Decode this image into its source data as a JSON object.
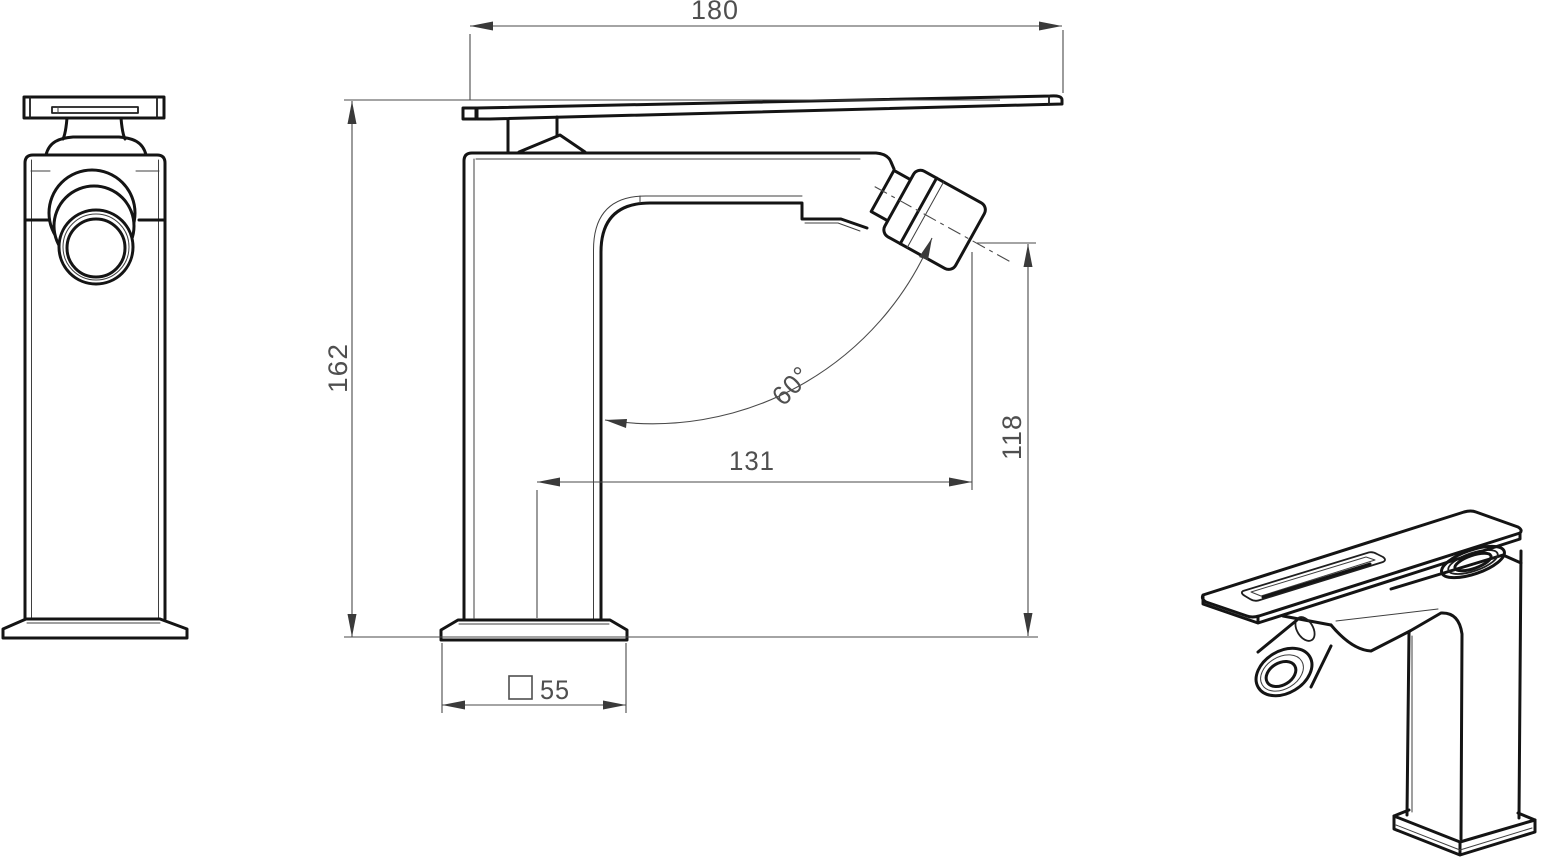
{
  "drawing": {
    "dimensions": {
      "lever_length": "180",
      "overall_height": "162",
      "spout_projection": "131",
      "aerator_height": "118",
      "spray_angle": "60°",
      "base_width": "55"
    },
    "colors": {
      "background": "#ffffff",
      "outline": "#141414",
      "dimension_lines": "#4a4a4a",
      "dimension_text": "#4f4f4f"
    }
  }
}
